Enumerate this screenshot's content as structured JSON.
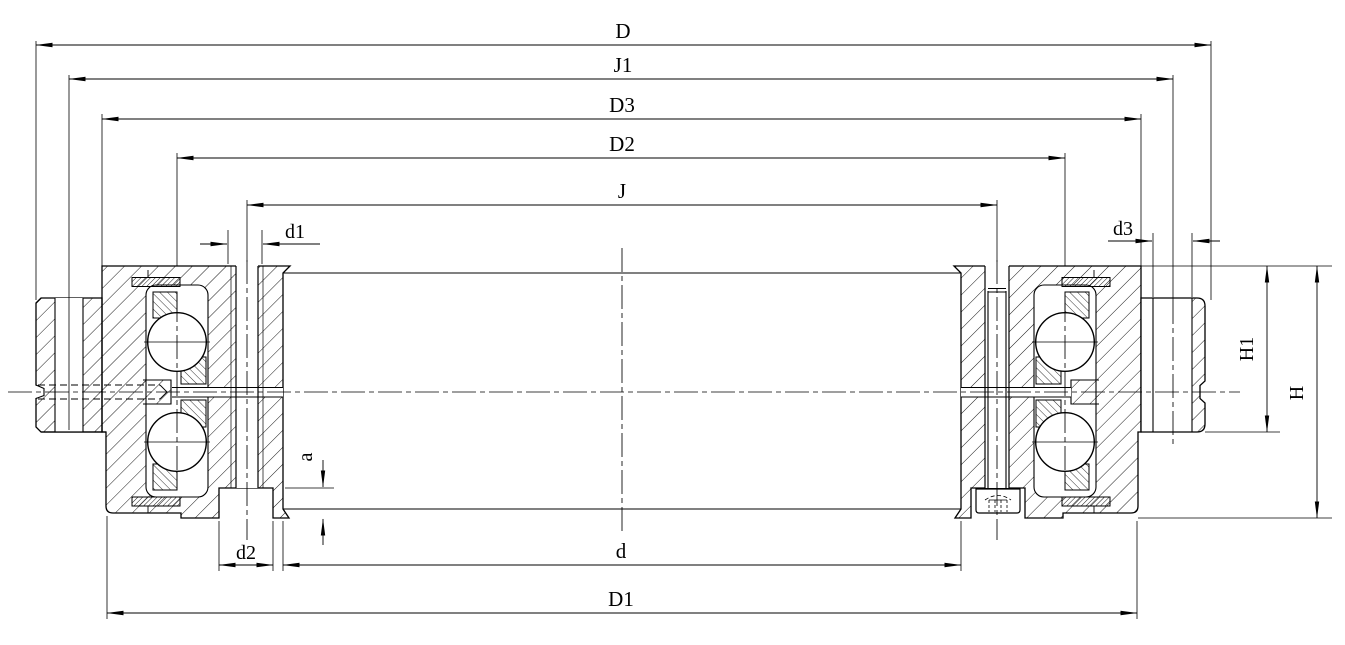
{
  "drawing": {
    "kind": "bearing cross-section engineering drawing",
    "colors": {
      "background": "#ffffff",
      "line": "#000000"
    },
    "dimension_labels": {
      "D": "D",
      "J1": "J1",
      "D3": "D3",
      "D2": "D2",
      "J": "J",
      "d1": "d1",
      "d3": "d3",
      "d2": "d2",
      "d": "d",
      "D1": "D1",
      "H1": "H1",
      "H": "H",
      "a": "a"
    }
  }
}
